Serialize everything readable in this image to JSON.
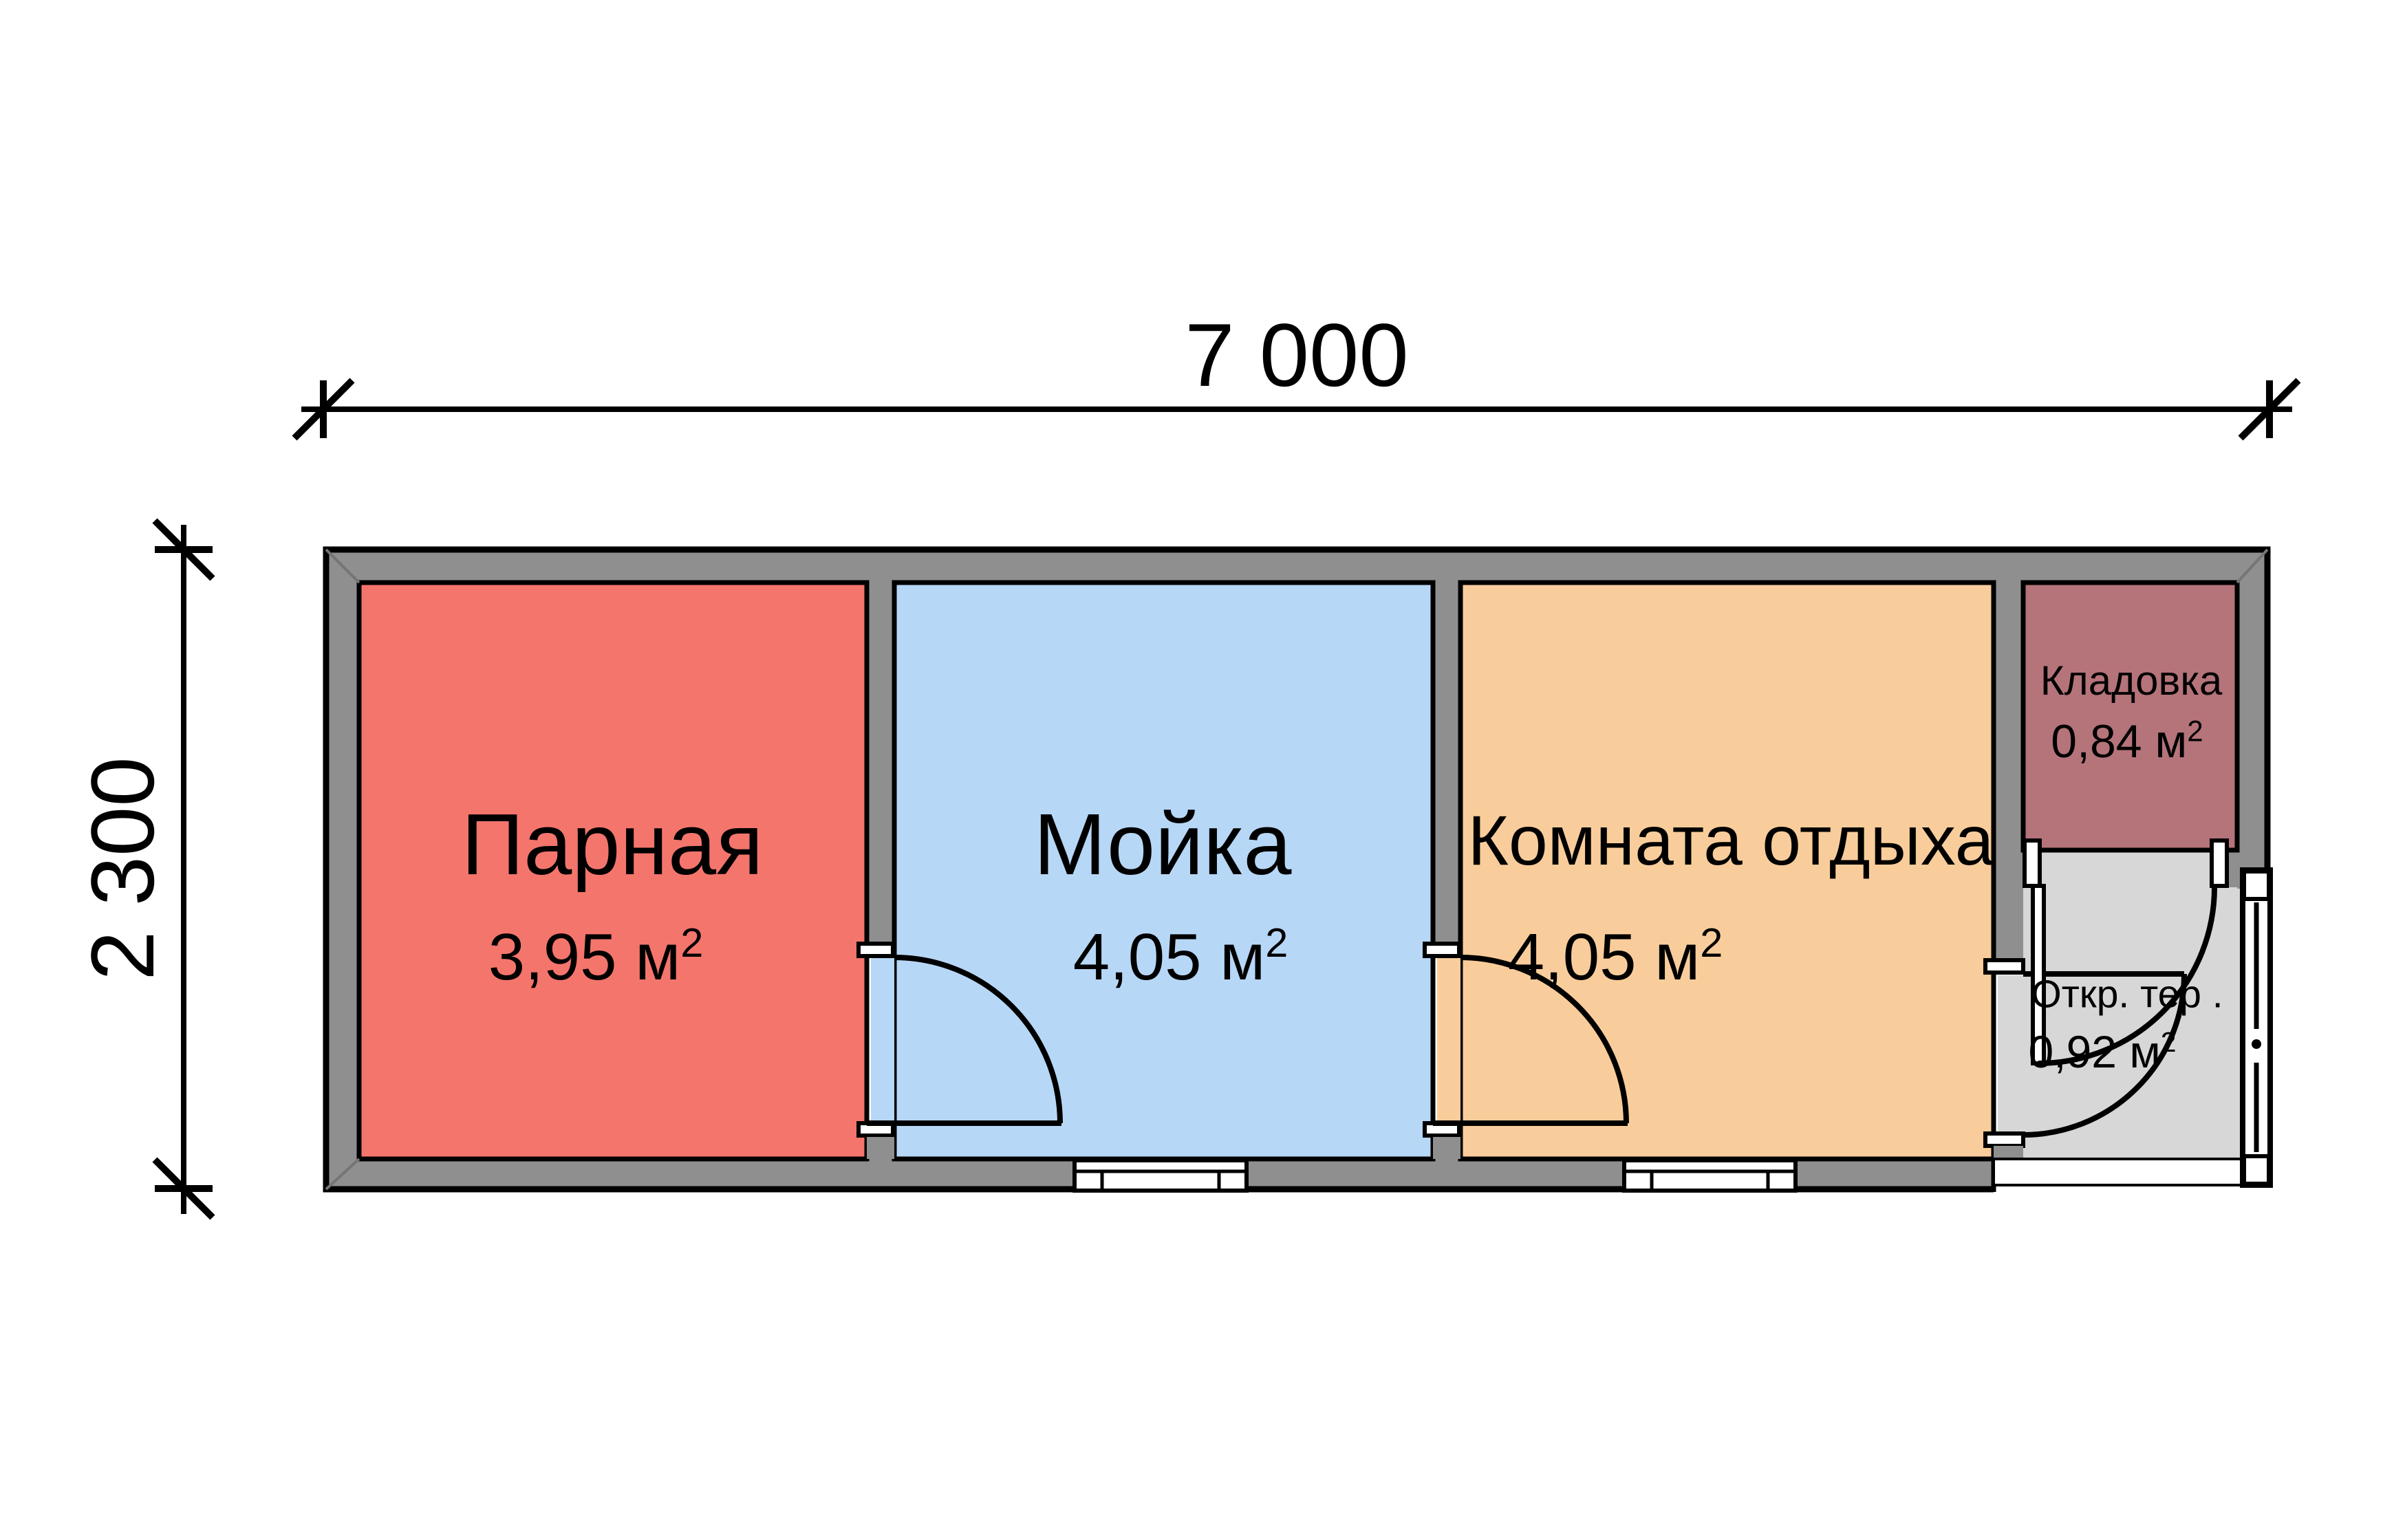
{
  "drawing": {
    "type": "floor-plan",
    "dimensions": {
      "width_label": "7 000",
      "height_label": "2 300"
    },
    "rooms": [
      {
        "name": "Парная",
        "area": "3,95 м²",
        "color": "#f4756c"
      },
      {
        "name": "Мойка",
        "area": "4,05 м²",
        "color": "#b7d7f6"
      },
      {
        "name": "Комната отдыха",
        "area": "4,05 м²",
        "color": "#f9cd9b"
      },
      {
        "name": "Кладовка",
        "area": "0,84 м²",
        "color": "#b5747a"
      },
      {
        "name": "Откр. тер .",
        "area": "0,92 м²",
        "color": "#d7d7d7"
      }
    ],
    "colors": {
      "wall": "#8f8f8f",
      "outline": "#000000",
      "background": "#ffffff",
      "door": "#ffffff",
      "miter": "#757575"
    }
  }
}
